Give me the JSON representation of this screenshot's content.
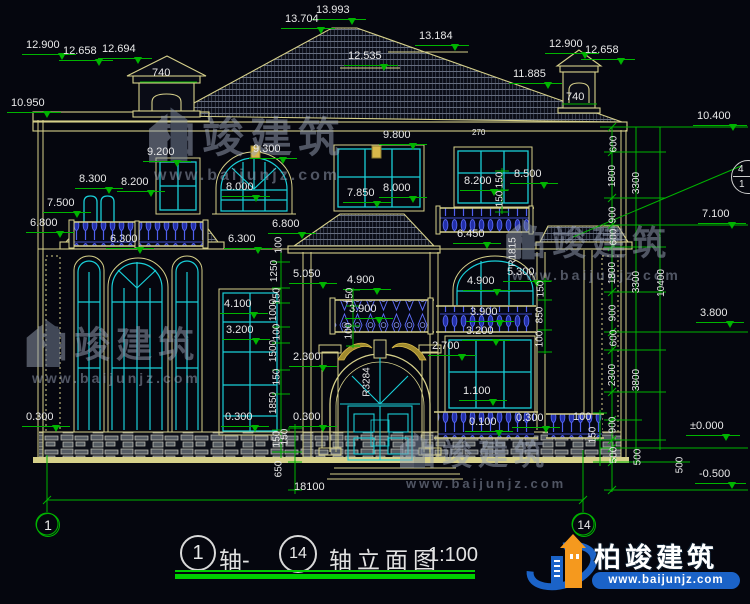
{
  "drawing_type": "building-elevation",
  "title_block": {
    "axis1": "1",
    "axis_sep": "轴-",
    "axis2": "14",
    "name": "轴立面图",
    "scale": "1:100"
  },
  "axis_bubbles": {
    "left": "1",
    "right": "14"
  },
  "callout": {
    "top": "4",
    "bottom": "1"
  },
  "logo": {
    "name": "柏竣建筑",
    "url": "www.baijunjz.com"
  },
  "watermark": {
    "name": "柏竣建筑",
    "url": "www.baijunjz.com"
  },
  "roof_levels": [
    "13.993",
    "13.704",
    "12.535",
    "13.184",
    "11.885"
  ],
  "left_chimney_levels": [
    "12.900",
    "12.658",
    "12.694"
  ],
  "right_chimney_levels": [
    "12.900",
    "12.658"
  ],
  "chimney_width": "740",
  "left_levels": [
    "10.950",
    "9.200",
    "8.300",
    "8.200",
    "7.500",
    "6.800",
    "6.300",
    "0.300"
  ],
  "center_levels": [
    "9.300",
    "9.800",
    "8.000",
    "7.850",
    "8.000",
    "6.800",
    "6.300",
    "5.050",
    "4.900",
    "4.100",
    "3.200",
    "3.900",
    "2.300",
    "0.300",
    "0.300"
  ],
  "right_bay_levels": [
    "8.200",
    "8.500",
    "6.450",
    "5.300",
    "4.900",
    "3.900",
    "3.200",
    "2.700",
    "1.100",
    "0.100",
    "0.300"
  ],
  "right_levels": [
    "10.400",
    "7.100",
    "3.800",
    "±0.000",
    "-0.500"
  ],
  "right_chain_a": [
    "600",
    "1800",
    "900",
    "600",
    "1800",
    "900",
    "600",
    "2300",
    "900",
    "500"
  ],
  "right_chain_b": [
    "3300",
    "3300",
    "3800",
    "500"
  ],
  "right_chain_total": "10400",
  "center_chain": [
    "100",
    "1250",
    "150",
    "1000",
    "100",
    "1500",
    "150",
    "1850",
    "150"
  ],
  "entrance_chain": [
    "150",
    "100"
  ],
  "bay_chain_upper": [
    "150",
    "150"
  ],
  "bay_chain_lower": [
    "150",
    "850",
    "100"
  ],
  "base_dims": [
    "150",
    "650",
    "100",
    "150",
    "500"
  ],
  "overall_width": "18100",
  "misc_dims": [
    "270"
  ],
  "arc_labels": {
    "entrance": "R3284",
    "window": "R1815"
  },
  "colors": {
    "dim_green": "#00b400",
    "line_yellow": "#d6d08a",
    "frame_cyan": "#19cfd8",
    "railing_blue": "#4f5ff2",
    "logo_blue": "#1b63c8",
    "logo_orange": "#f5991e",
    "background": "#05060e"
  }
}
